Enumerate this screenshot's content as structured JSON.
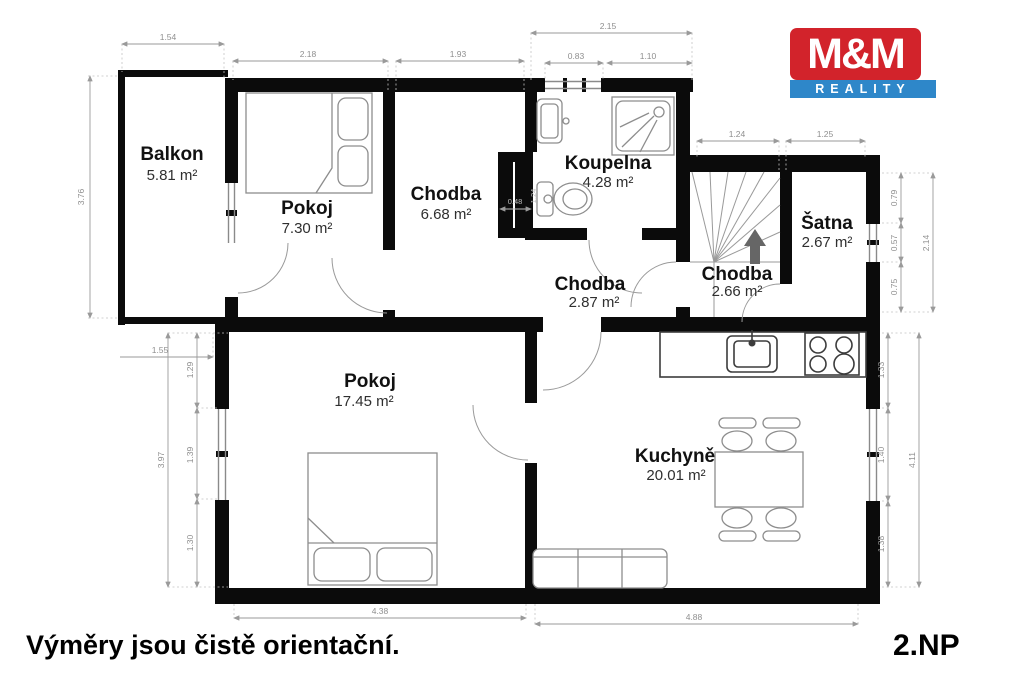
{
  "logo": {
    "line1": "M&M",
    "line2": "REALITY",
    "red": "#d2232b",
    "blue": "#2e87c9"
  },
  "footer": {
    "disclaimer": "Výměry jsou čistě orientační.",
    "floor": "2.NP"
  },
  "rooms": [
    {
      "name": "Balkon",
      "area": "5.81 m²"
    },
    {
      "name": "Pokoj",
      "area": "7.30 m²"
    },
    {
      "name": "Chodba",
      "area": "6.68 m²"
    },
    {
      "name": "Koupelna",
      "area": "4.28 m²"
    },
    {
      "name": "Chodba",
      "area": "2.87 m²"
    },
    {
      "name": "Chodba",
      "area": "2.66 m²"
    },
    {
      "name": "Šatna",
      "area": "2.67 m²"
    },
    {
      "name": "Pokoj",
      "area": "17.45 m²"
    },
    {
      "name": "Kuchyně",
      "area": "20.01 m²"
    }
  ],
  "dims": {
    "balkon_width": "1.54",
    "balkon_height": "3.76",
    "pokoj1_width": "2.18",
    "chodba1_width": "1.93",
    "koupelna_width_total": "2.15",
    "koupelna_w1": "0.83",
    "koupelna_w2": "1.10",
    "schodiste_width": "1.24",
    "satna_width": "1.25",
    "satna_h1": "0.79",
    "satna_h2": "0.57",
    "satna_h3": "0.75",
    "satna_height_total": "2.14",
    "sachta_width": "0.48",
    "sachta_height": "1.24",
    "pokoj2_offset": "1.55",
    "pokoj2_h1": "1.29",
    "pokoj2_h2": "1.39",
    "pokoj2_h3": "1.30",
    "pokoj2_height_total": "3.97",
    "pokoj2_width": "4.38",
    "kuchyne_h1": "1.33",
    "kuchyne_h2": "1.40",
    "kuchyne_h3": "1.38",
    "kuchyne_height_total": "4.11",
    "kuchyne_width": "4.88"
  }
}
